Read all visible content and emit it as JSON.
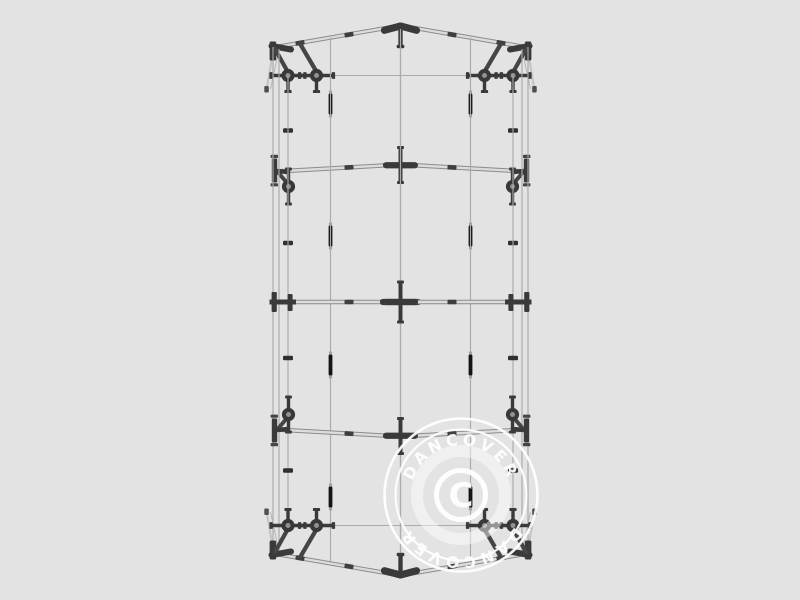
{
  "image": {
    "width": 800,
    "height": 600,
    "background": "#e3e3e3",
    "subject": "tent-frame-top-view-technical-drawing"
  },
  "watermark": {
    "brand_top": "DANCOVER",
    "brand_bottom": "DANCOVER",
    "copyright_letter": "C",
    "color": "#ffffff",
    "cx": 461,
    "cy": 495,
    "outer_ring_r": 76.5,
    "mid_ring_r": 65.5,
    "glow_ring_r": 44,
    "copyright_circle_r": 24.5,
    "top_text_r": 50,
    "bottom_text_r": 62,
    "font_size": 15.5,
    "letter_spacing": 4,
    "opacity": 0.93
  },
  "drawing": {
    "colors": {
      "background": "#e3e3e3",
      "thin_line": "#ababab",
      "pole_edge": "#8b8b8b",
      "pole_fill": "#dcdcdc",
      "connector": "#3a3a3a",
      "brace": "#454545",
      "knob_center": "#919191",
      "mark": "#141414",
      "clip": "#303030",
      "flare_light": "#c4c4c4",
      "flare_faint": "#b6b6b6",
      "foot_tip": "#4f4f4f"
    },
    "geometry": {
      "mirror_sum_x": 801,
      "mirror_sum_y": 601,
      "center_x": 400.5,
      "vertical_lines": [
        {
          "x": 273,
          "y1": 47,
          "y2": 554
        },
        {
          "x": 279,
          "y1": 49,
          "y2": 552
        },
        {
          "x": 288,
          "y1": 75.5,
          "y2": 525.5
        },
        {
          "x": 330.5,
          "y1": 37.5,
          "y2": 563.5
        },
        {
          "x": 400.5,
          "y1": 29,
          "y2": 572
        }
      ],
      "tie": {
        "y": 75.5,
        "x1": 276,
        "x2": 400.5
      },
      "rafter": {
        "x1": 273,
        "y1": 47.5,
        "x2": 400.5,
        "y2": 25.5
      },
      "truss2_pole": {
        "x1": 276,
        "y1": 171.5,
        "x2": 400.5,
        "y2": 164.5
      },
      "truss3_y": 302,
      "apex": {
        "y_tip": 26,
        "y_arm": 30.3,
        "arm_x": 384.5,
        "stub_y2": 46.5
      },
      "gable_knobs_x": [
        288,
        316.5
      ],
      "gable_knob_y": 75.5,
      "truss2_knob": {
        "x": 288.5,
        "y": 186.5
      },
      "bay_marks": [
        {
          "x": 330.5,
          "y": 104
        },
        {
          "x": 330.5,
          "y": 236
        }
      ],
      "clips": [
        {
          "x": 288,
          "y": 130.5
        },
        {
          "x": 288,
          "y": 243
        }
      ],
      "gable_sleeves": [
        {
          "x": 300,
          "y": 42.9,
          "a": -9.6
        },
        {
          "x": 349,
          "y": 34.6,
          "a": -9.6
        }
      ],
      "truss2_sleeve": {
        "x": 349,
        "y": 167.4,
        "a": -3.3
      },
      "truss3_sleeve": {
        "x": 349,
        "y": 302,
        "a": 0
      }
    }
  }
}
